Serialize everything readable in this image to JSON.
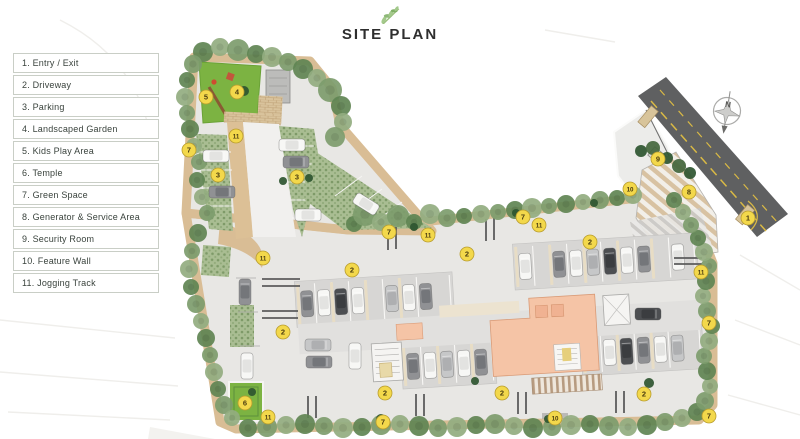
{
  "title": "SITE PLAN",
  "compass": {
    "label": "N"
  },
  "colors": {
    "badge": "#f3d84b",
    "track": "#d9bd95",
    "road": "#5f6061",
    "grass": "#7cb342",
    "salmon": "#f5c4a6",
    "site": "#e8e7e4"
  },
  "legend": {
    "items": [
      {
        "number": "1",
        "label": "Entry / Exit"
      },
      {
        "number": "2",
        "label": "Driveway"
      },
      {
        "number": "3",
        "label": "Parking"
      },
      {
        "number": "4",
        "label": "Landscaped Garden"
      },
      {
        "number": "5",
        "label": "Kids Play Area"
      },
      {
        "number": "6",
        "label": "Temple"
      },
      {
        "number": "7",
        "label": "Green Space"
      },
      {
        "number": "8",
        "label": "Generator & Service Area"
      },
      {
        "number": "9",
        "label": "Security Room"
      },
      {
        "number": "10",
        "label": "Feature Wall"
      },
      {
        "number": "11",
        "label": "Jogging Track"
      }
    ]
  },
  "plan": {
    "badges": [
      {
        "n": "5",
        "x": 206,
        "y": 97
      },
      {
        "n": "4",
        "x": 237,
        "y": 92
      },
      {
        "n": "11",
        "x": 236,
        "y": 136
      },
      {
        "n": "7",
        "x": 189,
        "y": 150
      },
      {
        "n": "3",
        "x": 218,
        "y": 175
      },
      {
        "n": "3",
        "x": 297,
        "y": 177
      },
      {
        "n": "7",
        "x": 389,
        "y": 232
      },
      {
        "n": "11",
        "x": 428,
        "y": 235
      },
      {
        "n": "7",
        "x": 523,
        "y": 217
      },
      {
        "n": "11",
        "x": 539,
        "y": 225
      },
      {
        "n": "2",
        "x": 590,
        "y": 242
      },
      {
        "n": "9",
        "x": 658,
        "y": 159
      },
      {
        "n": "10",
        "x": 630,
        "y": 189
      },
      {
        "n": "8",
        "x": 689,
        "y": 192
      },
      {
        "n": "1",
        "x": 748,
        "y": 218
      },
      {
        "n": "11",
        "x": 263,
        "y": 258
      },
      {
        "n": "2",
        "x": 352,
        "y": 270
      },
      {
        "n": "2",
        "x": 467,
        "y": 254
      },
      {
        "n": "2",
        "x": 283,
        "y": 332
      },
      {
        "n": "2",
        "x": 385,
        "y": 393
      },
      {
        "n": "2",
        "x": 502,
        "y": 393
      },
      {
        "n": "2",
        "x": 644,
        "y": 394
      },
      {
        "n": "11",
        "x": 701,
        "y": 272
      },
      {
        "n": "7",
        "x": 709,
        "y": 323
      },
      {
        "n": "7",
        "x": 709,
        "y": 416
      },
      {
        "n": "10",
        "x": 555,
        "y": 418
      },
      {
        "n": "6",
        "x": 245,
        "y": 403
      },
      {
        "n": "11",
        "x": 268,
        "y": 417
      },
      {
        "n": "7",
        "x": 383,
        "y": 422
      }
    ],
    "tree_palette": [
      "#7d9c6d",
      "#5f8453",
      "#92ad80",
      "#43663c",
      "#2e5530"
    ],
    "trees": [
      [
        203,
        52,
        10,
        1
      ],
      [
        220,
        47,
        9,
        2
      ],
      [
        238,
        50,
        11,
        0
      ],
      [
        256,
        54,
        9,
        1
      ],
      [
        272,
        57,
        10,
        2
      ],
      [
        288,
        62,
        9,
        0
      ],
      [
        303,
        69,
        10,
        1
      ],
      [
        317,
        78,
        9,
        2
      ],
      [
        330,
        90,
        12,
        0
      ],
      [
        341,
        106,
        10,
        1
      ],
      [
        343,
        122,
        9,
        2
      ],
      [
        335,
        137,
        10,
        0
      ],
      [
        193,
        64,
        9,
        0
      ],
      [
        187,
        80,
        8,
        1
      ],
      [
        185,
        97,
        9,
        2
      ],
      [
        187,
        113,
        8,
        0
      ],
      [
        190,
        129,
        9,
        1
      ],
      [
        194,
        146,
        8,
        2
      ],
      [
        199,
        162,
        8,
        0
      ],
      [
        197,
        180,
        8,
        1
      ],
      [
        202,
        197,
        8,
        2
      ],
      [
        207,
        213,
        8,
        0
      ],
      [
        198,
        233,
        9,
        1
      ],
      [
        192,
        251,
        8,
        0
      ],
      [
        189,
        269,
        9,
        2
      ],
      [
        191,
        287,
        8,
        1
      ],
      [
        196,
        304,
        9,
        0
      ],
      [
        201,
        321,
        8,
        2
      ],
      [
        206,
        338,
        9,
        1
      ],
      [
        210,
        355,
        8,
        0
      ],
      [
        214,
        372,
        9,
        2
      ],
      [
        218,
        389,
        8,
        1
      ],
      [
        224,
        405,
        9,
        0
      ],
      [
        232,
        418,
        8,
        2
      ],
      [
        248,
        428,
        9,
        1
      ],
      [
        267,
        427,
        10,
        0
      ],
      [
        286,
        425,
        9,
        2
      ],
      [
        305,
        424,
        10,
        1
      ],
      [
        324,
        426,
        9,
        0
      ],
      [
        343,
        428,
        10,
        2
      ],
      [
        362,
        427,
        9,
        1
      ],
      [
        381,
        425,
        10,
        0
      ],
      [
        400,
        424,
        9,
        2
      ],
      [
        419,
        426,
        10,
        1
      ],
      [
        438,
        428,
        9,
        0
      ],
      [
        457,
        427,
        10,
        2
      ],
      [
        476,
        425,
        9,
        1
      ],
      [
        495,
        424,
        10,
        0
      ],
      [
        514,
        426,
        9,
        2
      ],
      [
        533,
        428,
        10,
        1
      ],
      [
        552,
        427,
        9,
        0
      ],
      [
        571,
        425,
        10,
        2
      ],
      [
        590,
        424,
        9,
        1
      ],
      [
        609,
        426,
        10,
        0
      ],
      [
        628,
        427,
        9,
        2
      ],
      [
        647,
        425,
        10,
        1
      ],
      [
        665,
        422,
        9,
        0
      ],
      [
        682,
        418,
        9,
        2
      ],
      [
        697,
        412,
        9,
        1
      ],
      [
        705,
        401,
        9,
        0
      ],
      [
        710,
        386,
        8,
        2
      ],
      [
        707,
        371,
        9,
        1
      ],
      [
        704,
        356,
        8,
        0
      ],
      [
        709,
        341,
        9,
        2
      ],
      [
        712,
        326,
        8,
        1
      ],
      [
        707,
        311,
        9,
        0
      ],
      [
        703,
        296,
        8,
        2
      ],
      [
        706,
        281,
        9,
        1
      ],
      [
        709,
        266,
        8,
        0
      ],
      [
        704,
        252,
        9,
        2
      ],
      [
        698,
        238,
        8,
        1
      ],
      [
        691,
        225,
        8,
        0
      ],
      [
        683,
        212,
        8,
        2
      ],
      [
        674,
        200,
        8,
        1
      ],
      [
        641,
        151,
        6,
        4
      ],
      [
        653,
        148,
        7,
        3
      ],
      [
        667,
        158,
        6,
        4
      ],
      [
        679,
        166,
        7,
        3
      ],
      [
        690,
        173,
        6,
        4
      ],
      [
        354,
        224,
        8,
        1
      ],
      [
        365,
        214,
        12,
        0
      ],
      [
        381,
        222,
        9,
        2
      ],
      [
        398,
        216,
        11,
        0
      ],
      [
        414,
        222,
        8,
        1
      ],
      [
        430,
        214,
        10,
        2
      ],
      [
        447,
        218,
        9,
        0
      ],
      [
        464,
        216,
        8,
        1
      ],
      [
        481,
        214,
        9,
        2
      ],
      [
        498,
        212,
        8,
        0
      ],
      [
        515,
        210,
        9,
        1
      ],
      [
        532,
        208,
        10,
        2
      ],
      [
        549,
        206,
        8,
        0
      ],
      [
        566,
        204,
        9,
        1
      ],
      [
        583,
        202,
        8,
        2
      ],
      [
        600,
        200,
        9,
        0
      ],
      [
        617,
        198,
        8,
        1
      ],
      [
        633,
        195,
        9,
        2
      ],
      [
        414,
        227,
        4,
        4
      ],
      [
        516,
        213,
        4,
        4
      ],
      [
        594,
        203,
        4,
        4
      ],
      [
        283,
        181,
        4,
        4
      ],
      [
        309,
        178,
        4,
        4
      ],
      [
        649,
        383,
        5,
        4
      ],
      [
        475,
        381,
        4,
        4
      ],
      [
        252,
        392,
        4,
        4
      ],
      [
        244,
        91,
        5,
        4
      ],
      [
        381,
        419,
        5,
        4
      ],
      [
        548,
        419,
        4,
        4
      ]
    ],
    "car_colors": {
      "white": [
        "#f7f7f5",
        "#e3e3e1"
      ],
      "gray": [
        "#909194",
        "#74767a"
      ],
      "dark": [
        "#4d4f52",
        "#3b3d40"
      ],
      "silver": [
        "#c6c7c8",
        "#aeafb1"
      ]
    },
    "cars": [
      [
        216,
        156,
        90,
        "white"
      ],
      [
        222,
        192,
        90,
        "gray"
      ],
      [
        292,
        145,
        90,
        "white"
      ],
      [
        296,
        162,
        90,
        "gray"
      ],
      [
        308,
        215,
        90,
        "white"
      ],
      [
        366,
        204,
        122,
        "white"
      ],
      [
        245,
        292,
        0,
        "gray"
      ],
      [
        247,
        366,
        0,
        "white"
      ],
      [
        318,
        345,
        90,
        "silver"
      ],
      [
        319,
        362,
        90,
        "gray"
      ],
      [
        355,
        356,
        0,
        "white"
      ],
      [
        648,
        314,
        90,
        "dark"
      ]
    ],
    "parking_rows": [
      {
        "x0": 300,
        "x1": 452,
        "y": 272,
        "h": 40
      },
      {
        "x0": 520,
        "x1": 698,
        "y": 248,
        "h": 40
      },
      {
        "x0": 402,
        "x1": 490,
        "y": 342,
        "h": 38
      },
      {
        "x0": 582,
        "x1": 698,
        "y": 340,
        "h": 38
      }
    ],
    "car_cycle": [
      "gray",
      "white",
      "dark",
      "white",
      "none",
      "silver",
      "white",
      "gray",
      "white",
      "none",
      "gray",
      "white",
      "silver",
      "dark",
      "white",
      "gray",
      "none",
      "white",
      "gray",
      "white",
      "silver",
      "white",
      "gray",
      "none",
      "white",
      "dark",
      "gray",
      "white",
      "silver",
      "white"
    ]
  }
}
